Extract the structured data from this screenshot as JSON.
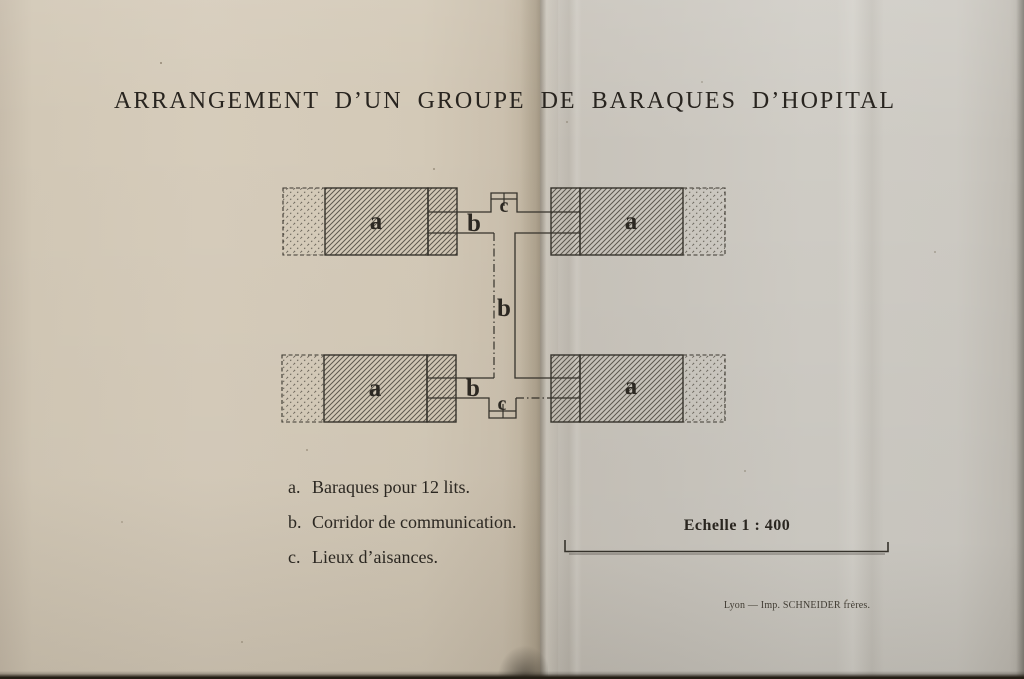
{
  "page": {
    "title": "ARRANGEMENT D’UN GROUPE DE BARAQUES D’HOPITAL",
    "paper_left_color": "#d5cbba",
    "paper_right_color": "#cdc9c2",
    "ink_color": "#2e2b25"
  },
  "diagram": {
    "label_a": "a",
    "label_b": "b",
    "label_c": "c"
  },
  "legend": {
    "items": [
      {
        "key": "a.",
        "text": "Baraques pour 12 lits."
      },
      {
        "key": "b.",
        "text": "Corridor de communication."
      },
      {
        "key": "c.",
        "text": "Lieux d’aisances."
      }
    ]
  },
  "scale": {
    "label": "Echelle 1 : 400"
  },
  "imprint": {
    "text": "Lyon — Imp. SCHNEIDER frères."
  }
}
